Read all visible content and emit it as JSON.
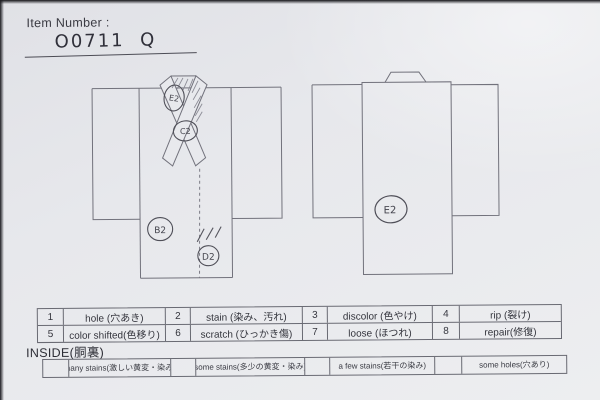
{
  "header": {
    "label": "Item Number :",
    "value": "O0711  Q"
  },
  "diagrams": {
    "front_kimono": {
      "description": "kimono front view with crossed hatched collar",
      "marks": [
        {
          "code": "E2",
          "location": "left-collar"
        },
        {
          "code": "C2",
          "location": "collar-crossing"
        },
        {
          "code": "B2",
          "location": "left-front-panel"
        },
        {
          "code": "D2",
          "location": "center-front-hem"
        }
      ]
    },
    "back_kimono": {
      "description": "kimono back view",
      "marks": [
        {
          "code": "E2",
          "location": "center-back"
        }
      ]
    }
  },
  "legend": {
    "cells": [
      {
        "n": "1",
        "t": "hole (穴あき)"
      },
      {
        "n": "2",
        "t": "stain (染み、汚れ)"
      },
      {
        "n": "3",
        "t": "discolor (色やけ)"
      },
      {
        "n": "4",
        "t": "rip (裂け)"
      },
      {
        "n": "5",
        "t": "color shifted(色移り)"
      },
      {
        "n": "6",
        "t": "scratch (ひっかき傷)"
      },
      {
        "n": "7",
        "t": "loose (ほつれ)"
      },
      {
        "n": "8",
        "t": "repair(修復)"
      }
    ]
  },
  "inside": {
    "label": "INSIDE(胴裏)",
    "options": [
      "many stains(激しい黄変・染み)",
      "some stains(多少の黄変・染み)",
      "a few stains(若干の染み)",
      "some holes(穴あり)"
    ]
  },
  "colors": {
    "paper": "#e8e9ed",
    "printed_line": "#72727c",
    "table_border": "#696a73",
    "printed_text": "#33343c",
    "pencil": "#4f4f58",
    "photo_edge": "#1d1d22"
  }
}
